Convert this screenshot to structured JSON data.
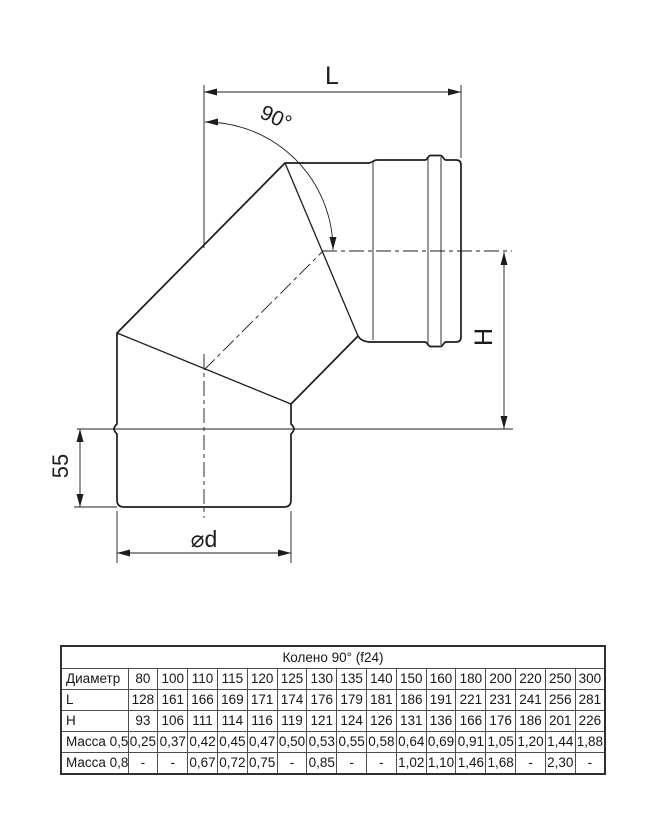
{
  "colors": {
    "ink": "#1c1c1c",
    "background": "#ffffff",
    "table_border": "#2e2e2e"
  },
  "diagram": {
    "labels": {
      "length": "L",
      "angle": "90°",
      "height": "H",
      "crimp_length": "55",
      "diameter": "⌀d"
    }
  },
  "table": {
    "title": "Колено 90° (f24)",
    "rows": [
      {
        "label": "Диаметр",
        "values": [
          "80",
          "100",
          "110",
          "115",
          "120",
          "125",
          "130",
          "135",
          "140",
          "150",
          "160",
          "180",
          "200",
          "220",
          "250",
          "300"
        ]
      },
      {
        "label": "L",
        "values": [
          "128",
          "161",
          "166",
          "169",
          "171",
          "174",
          "176",
          "179",
          "181",
          "186",
          "191",
          "221",
          "231",
          "241",
          "256",
          "281"
        ]
      },
      {
        "label": "H",
        "values": [
          "93",
          "106",
          "111",
          "114",
          "116",
          "119",
          "121",
          "124",
          "126",
          "131",
          "136",
          "166",
          "176",
          "186",
          "201",
          "226"
        ]
      },
      {
        "label": "Масса 0,5",
        "values": [
          "0,25",
          "0,37",
          "0,42",
          "0,45",
          "0,47",
          "0,50",
          "0,53",
          "0,55",
          "0,58",
          "0,64",
          "0,69",
          "0,91",
          "1,05",
          "1,20",
          "1,44",
          "1,88"
        ]
      },
      {
        "label": "Масса 0,8",
        "values": [
          "-",
          "-",
          "0,67",
          "0,72",
          "0,75",
          "-",
          "0,85",
          "-",
          "-",
          "1,02",
          "1,10",
          "1,46",
          "1,68",
          "-",
          "2,30",
          "-"
        ]
      }
    ]
  }
}
